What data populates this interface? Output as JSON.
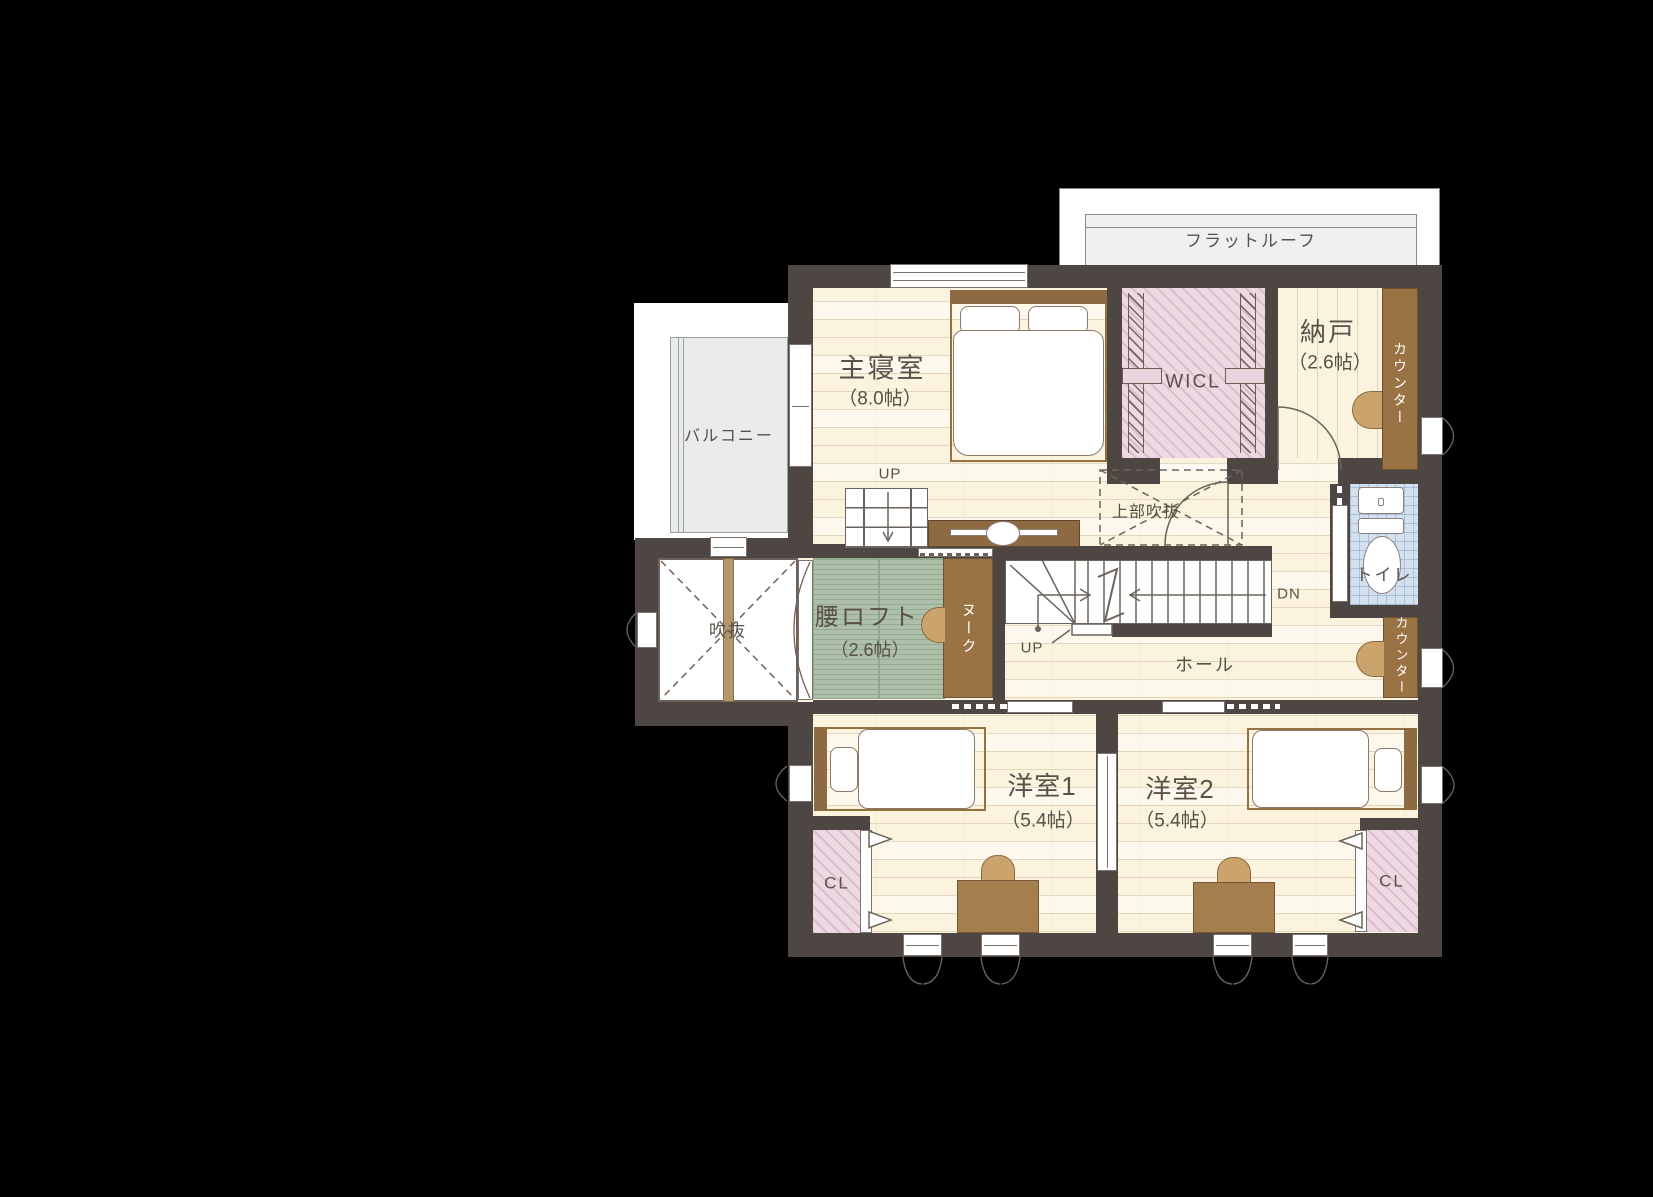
{
  "title": "2F floor plan",
  "labels": {
    "flat_roof": "フラットルーフ",
    "balcony": "バルコニー",
    "master_bedroom": {
      "name": "主寝室",
      "size": "（8.0帖）"
    },
    "wicl": "WICL",
    "storage": {
      "name": "納戸",
      "size": "（2.6帖）"
    },
    "counter_upper": "カウンター",
    "counter_lower": "カウンター",
    "toilet": "トイレ",
    "void_above": "上部吹抜",
    "void": "吹抜",
    "loft": {
      "name": "腰ロフト",
      "size": "（2.6帖）"
    },
    "nook": "ヌーク",
    "hall": "ホール",
    "up_ladder": "UP",
    "up_stairs": "UP",
    "down_stairs": "DN",
    "room1": {
      "name": "洋室1",
      "size": "（5.4帖）"
    },
    "room2": {
      "name": "洋室2",
      "size": "（5.4帖）"
    },
    "closet_left": "CL",
    "closet_right": "CL"
  },
  "colors": {
    "background": "#000000",
    "wall": "#4e4643",
    "floor": "#fbf3de",
    "tatami_green": "#aec0a9",
    "closet_pink": "#eed9e3",
    "toilet_blue": "#d3e1ef",
    "wood_brown": "#9a7345",
    "balcony_gray": "#e9eceb",
    "roof_gray": "#eff1f0",
    "text": "#585049"
  }
}
